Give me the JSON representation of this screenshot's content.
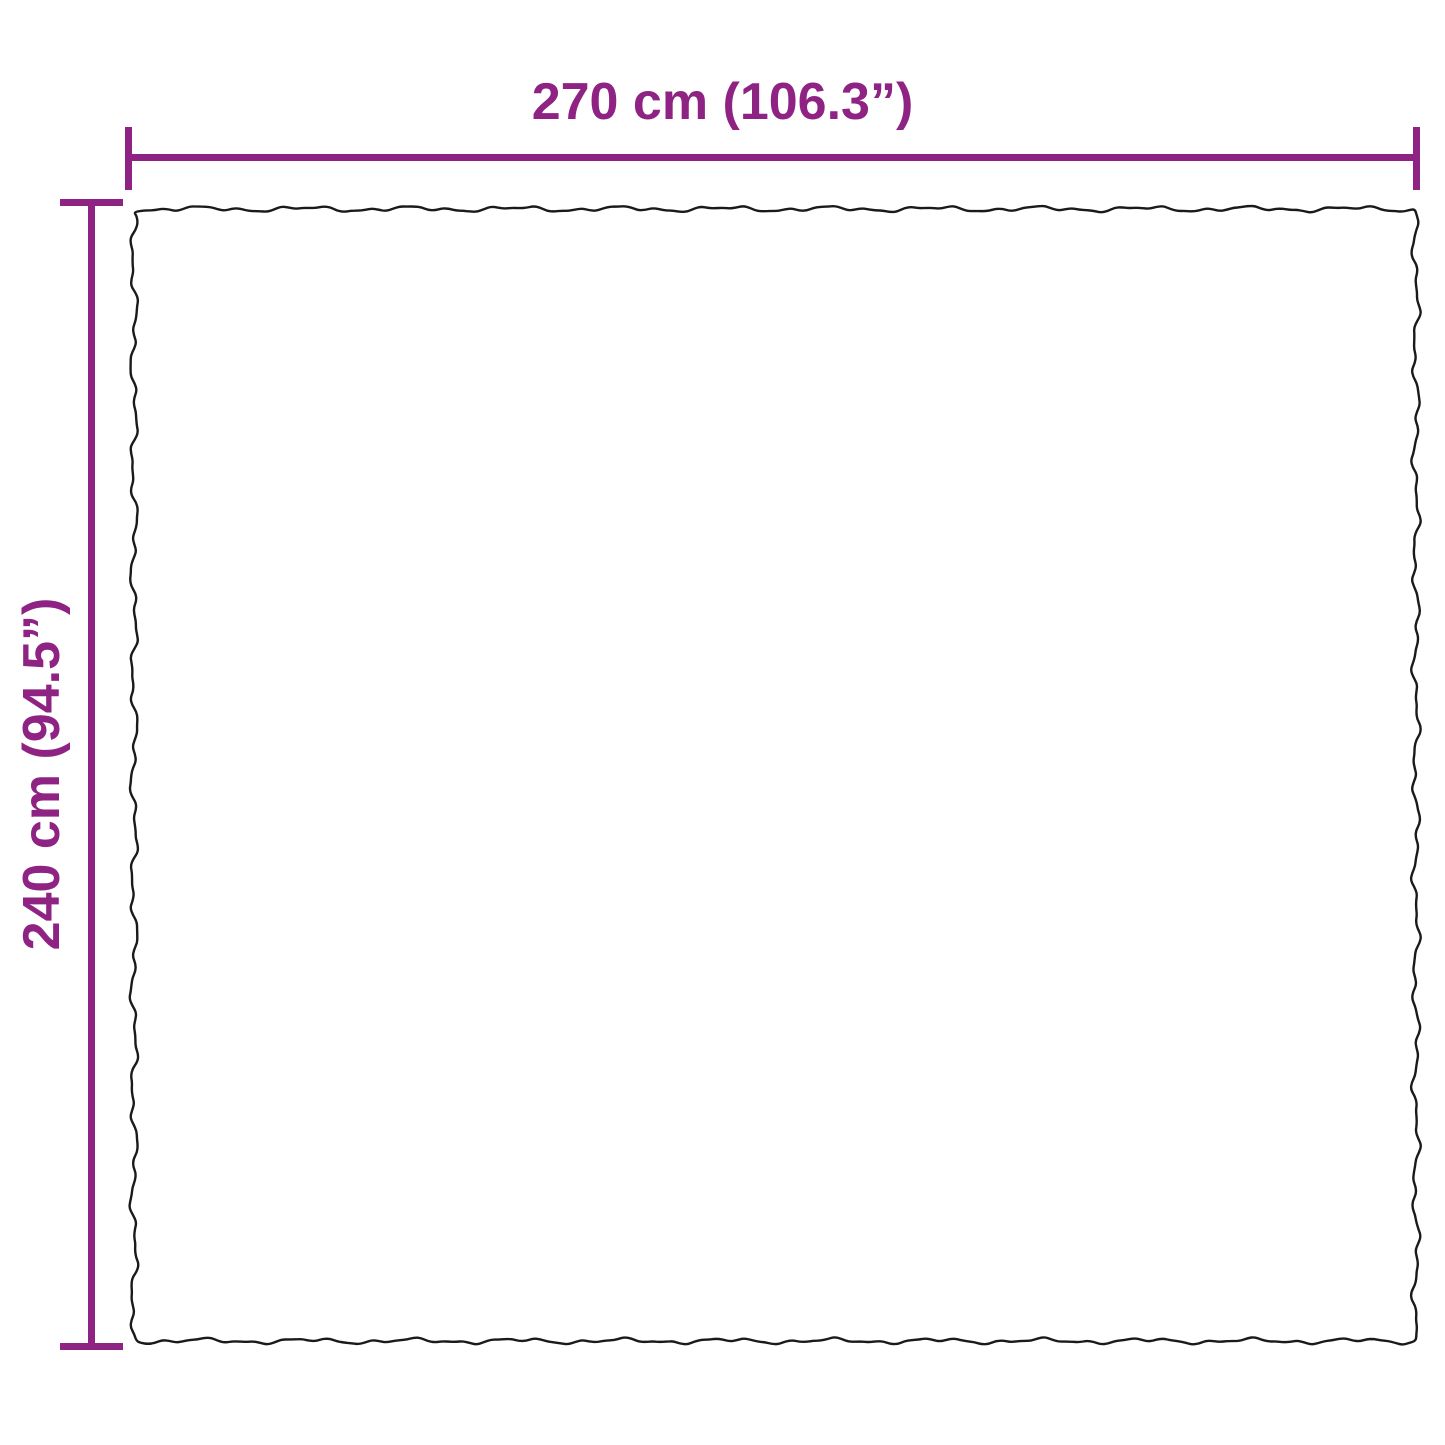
{
  "product_diagram": {
    "width_label": "270 cm (106.3”)",
    "height_label": "240 cm (94.5”)",
    "colors": {
      "dimension_accent": "#8E2383",
      "outline": "#1A1A1A",
      "background": "#FFFFFF"
    }
  }
}
